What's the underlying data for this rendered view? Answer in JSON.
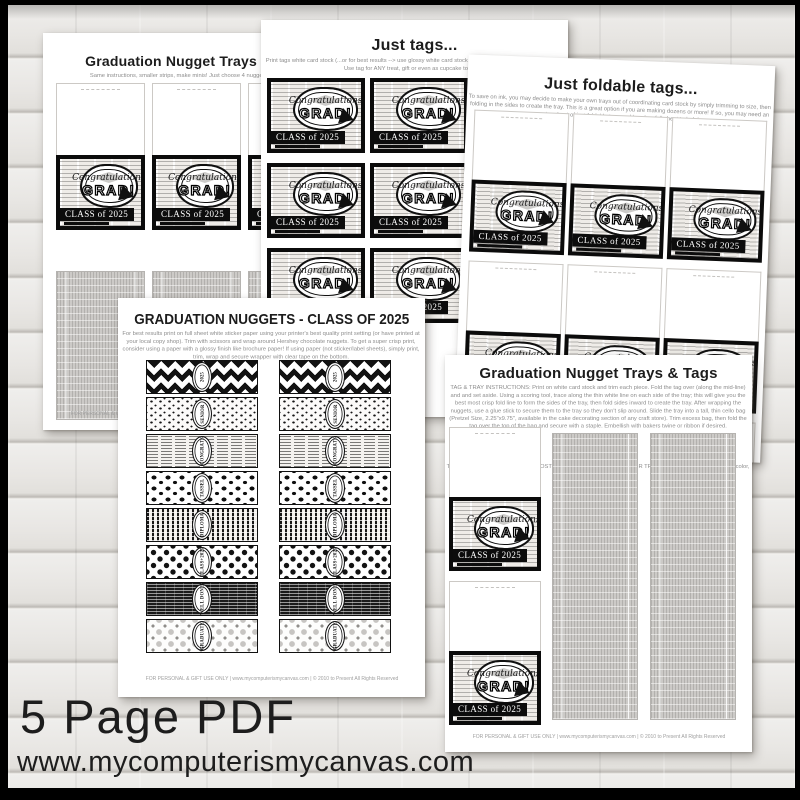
{
  "colors": {
    "frame": "#000000",
    "wood": "#e9e8e5",
    "ink": "#111111",
    "tray_gray": "#c6c4c1"
  },
  "caption": {
    "line1": "5 Page PDF",
    "line2": "www.mycomputerismycanvas.com"
  },
  "tag": {
    "header_word": "Congratulations",
    "grad_word": "GRAD!",
    "class_line": "CLASS of 2025"
  },
  "footer_line": "FOR PERSONAL & GIFT USE ONLY | www.mycomputerismycanvas.com | © 2010 to Present All Rights Reserved",
  "pages": {
    "mini": {
      "title": "Graduation Nugget Trays & Tags",
      "subtitle": "Same instructions, smaller strips, make minis! Just choose 4 nuggets for each tray.",
      "tag_slots": [
        {},
        {},
        {}
      ],
      "tray_slots": [
        {},
        {},
        {}
      ]
    },
    "just_tags": {
      "title": "Just tags...",
      "subtitle": "Print tags white card stock (...or for best results --> use glossy white card stock or photo paper with a photo setting). Use tag for ANY treat, gift or even as cupcake toppers!",
      "tag_slots": [
        {},
        {},
        {},
        {},
        {},
        {},
        {},
        {},
        {}
      ]
    },
    "foldable": {
      "title": "Just foldable tags...",
      "subtitle": "To save on ink, you may decide to make your own trays out of coordinating card stock by simply trimming to size, then folding in the sides to create the tray.  This is a great option if you are making dozens or more!  If so, you may need an extra sheet of just foldable tags and here's a full sheet to help!",
      "tag_slots": [
        {},
        {},
        {},
        {},
        {},
        {},
        {},
        {},
        {}
      ]
    },
    "nuggets": {
      "title": "GRADUATION NUGGETS - CLASS OF 2025",
      "subtitle": "For best results print on full sheet white sticker paper using your printer's best quality print setting (or have printed at your local copy shop). Trim with scissors and wrap around Hershey chocolate nuggets. To get a super crisp print, consider using a paper with a glossy finish like brochure paper! If using paper (not sticker/label sheets), simply print, trim, wrap and secure wrapper with clear tape on the bottom.",
      "strips": [
        {
          "pattern": "p-chevron",
          "label": "2025"
        },
        {
          "pattern": "p-confetti",
          "label": "SENIOR"
        },
        {
          "pattern": "p-news-light",
          "label": "CONGRATS"
        },
        {
          "pattern": "p-caps",
          "label": "TASSEL"
        },
        {
          "pattern": "p-stripes",
          "label": "DIPLOMA"
        },
        {
          "pattern": "p-polka",
          "label": "CLASS+2025"
        },
        {
          "pattern": "p-news-dark",
          "label": "WELL DONE!"
        },
        {
          "pattern": "p-diamonds",
          "label": "GRADUATE"
        }
      ]
    },
    "trays_tags": {
      "title": "Graduation Nugget Trays & Tags",
      "instructions": "TAG & TRAY INSTRUCTIONS: Print on white card stock and trim each piece. Fold the tag over (along the mid-line) and and set aside. Using a scoring tool, trace along the thin white line on each side of the tray; this will give you the best most crisp fold line to form the sides of the tray, then fold sides inward to create the tray. After wrapping the nuggets, use a glue stick to secure them to the tray so they don't slip around.  Slide the tray into a tall, thin cello bag (Pretzel Size, 2.25\"x9.75\", available in the cake decorating section of any craft store).  Trim excess bag, then fold the tag over the top of the bag and secure with a staple.  Embellish with bakers twine or ribbon if desired.",
      "tip": "TIP: TO SAVE ON INK/PRINTING COSTS, USE CARD STOCK FOR YOUR TRAYS INSTEAD. For a fun pop of color, use school colored card stock!",
      "tag_slots": [
        {},
        {}
      ],
      "tray_slots": [
        {},
        {}
      ]
    }
  }
}
